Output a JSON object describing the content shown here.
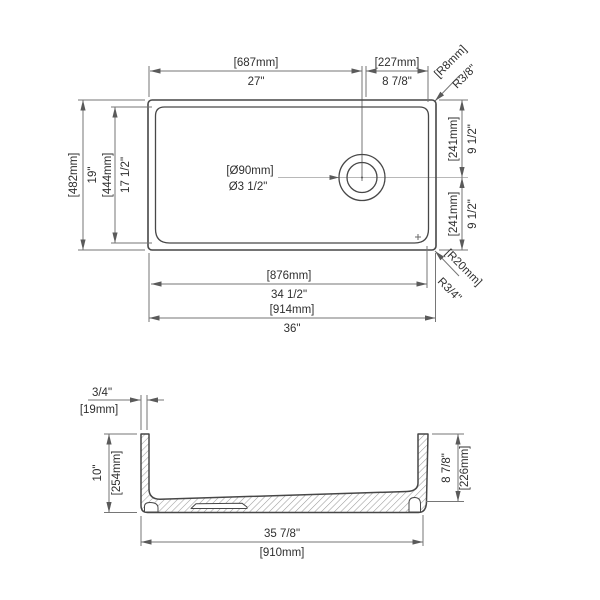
{
  "colors": {
    "object_line": "#474747",
    "dimension_line": "#767676",
    "centerline": "#b8b8b8",
    "text": "#2f2f2f",
    "hatch": "#9a9a9a",
    "background": "#ffffff"
  },
  "top_view": {
    "width_left_to_drain": {
      "mm": "[687mm]",
      "inches": "27\""
    },
    "width_drain_to_right": {
      "mm": "[227mm]",
      "inches": "8 7/8\""
    },
    "corner_radius_top_right": {
      "mm": "[R8mm]",
      "inches": "R3/8\""
    },
    "overall_depth": {
      "mm": "[482mm]",
      "inches": "19\""
    },
    "bowl_depth": {
      "mm": "[444mm]",
      "inches": "17 1/2\""
    },
    "drain_to_top_edge": {
      "mm": "[241mm]",
      "inches": "9 1/2\""
    },
    "drain_to_bottom_edge": {
      "mm": "[241mm]",
      "inches": "9 1/2\""
    },
    "corner_radius_bottom_right": {
      "mm": "[R20mm]",
      "inches": "R3/4\""
    },
    "drain_diameter": {
      "mm": "[Ø90mm]",
      "inches": "Ø3 1/2\""
    },
    "bowl_width": {
      "mm": "[876mm]",
      "inches": "34 1/2\""
    },
    "overall_width": {
      "mm": "[914mm]",
      "inches": "36\""
    }
  },
  "section_view": {
    "wall_thickness": {
      "inches": "3/4\"",
      "mm": "[19mm]"
    },
    "depth_left": {
      "inches": "10\"",
      "mm": "[254mm]"
    },
    "depth_right": {
      "inches": "8 7/8\"",
      "mm": "[226mm]"
    },
    "base_width": {
      "inches": "35 7/8\"",
      "mm": "[910mm]"
    }
  }
}
